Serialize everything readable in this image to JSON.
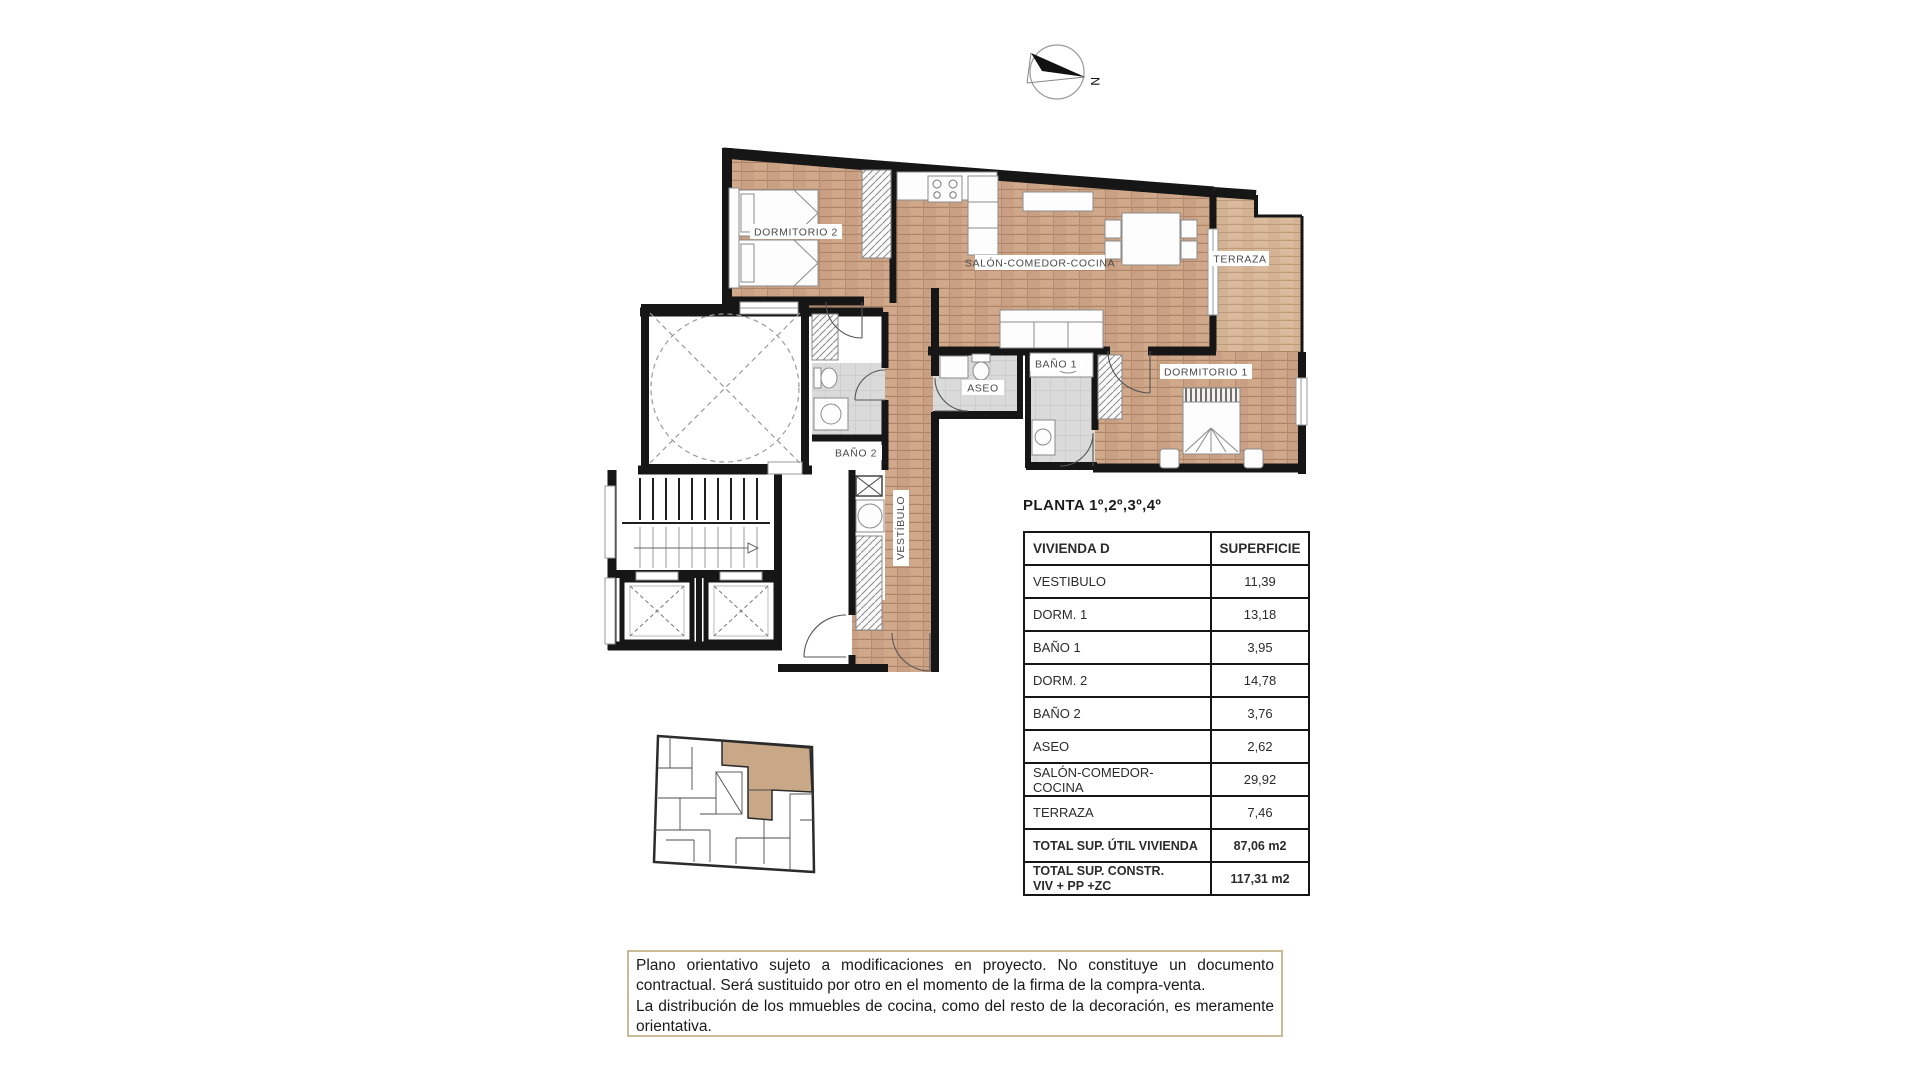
{
  "compass": {
    "north_label": "N"
  },
  "plan": {
    "labels": {
      "dormitorio2": "DORMITORIO 2",
      "salon": "SALÓN-COMEDOR-COCINA",
      "terraza": "TERRAZA",
      "bano1": "BAÑO 1",
      "dormitorio1": "DORMITORIO 1",
      "aseo": "ASEO",
      "bano2": "BAÑO 2",
      "vestibulo": "VESTÍBULO"
    },
    "colors": {
      "wood": "#c9a083",
      "wood_terrace": "#d4b294",
      "tile": "#dadada",
      "wall": "#161616",
      "highlight_unit": "#c9a887"
    }
  },
  "area_table": {
    "title": "PLANTA 1º,2º,3º,4º",
    "header": {
      "name": "VIVIENDA D",
      "area": "SUPERFICIE"
    },
    "rows": [
      {
        "label": "VESTIBULO",
        "value": "11,39"
      },
      {
        "label": "DORM. 1",
        "value": "13,18"
      },
      {
        "label": "BAÑO 1",
        "value": "3,95"
      },
      {
        "label": "DORM. 2",
        "value": "14,78"
      },
      {
        "label": "BAÑO 2",
        "value": "3,76"
      },
      {
        "label": "ASEO",
        "value": "2,62"
      },
      {
        "label": "SALÓN-COMEDOR-COCINA",
        "value": "29,92"
      },
      {
        "label": "TERRAZA",
        "value": "7,46"
      }
    ],
    "total_util": {
      "label": "TOTAL SUP. ÚTIL VIVIENDA",
      "value": "87,06 m2"
    },
    "total_constr": {
      "label_line1": "TOTAL SUP. CONSTR.",
      "label_line2": "VIV + PP +ZC",
      "value": "117,31 m2"
    }
  },
  "disclaimer": {
    "paragraph1": "Plano orientativo sujeto a modificaciones en proyecto. No constituye un documento contractual. Será sustituido por otro en el momento de la firma de la compra-venta.",
    "paragraph2": "La distribución de los mmuebles de cocina, como del resto de la decoración, es meramente orientativa."
  }
}
